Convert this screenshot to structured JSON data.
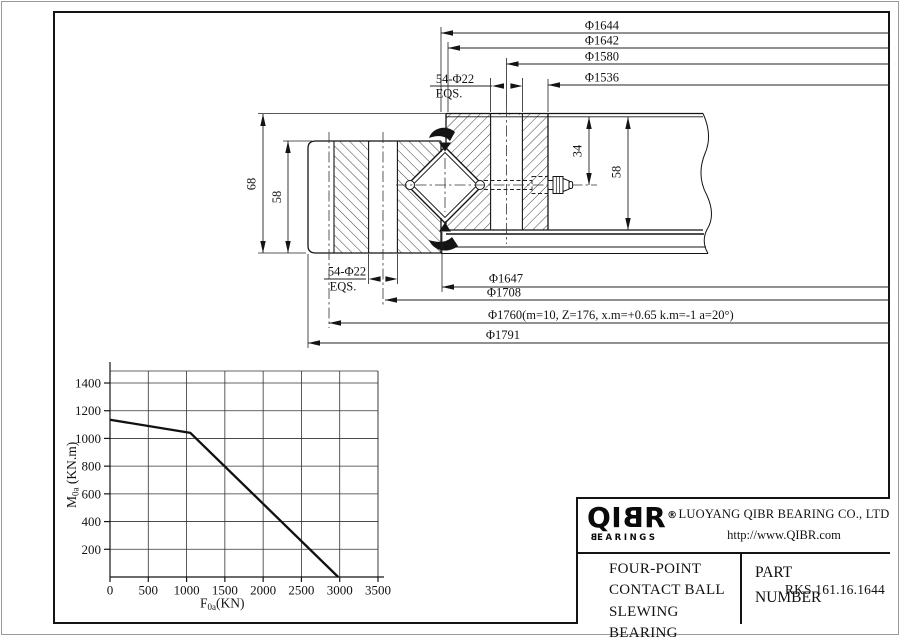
{
  "drawing": {
    "dims_top": [
      "Φ1644",
      "Φ1642",
      "Φ1580",
      "Φ1536"
    ],
    "bolt_top": {
      "line1": "54-Φ22",
      "line2": "EQS."
    },
    "bolt_bottom": {
      "line1": "54-Φ22",
      "line2": "EQS."
    },
    "dims_bottom": [
      "Φ1647",
      "Φ1708",
      "Φ1760(m=10, Z=176, x.m=+0.65 k.m=-1 a=20°)",
      "Φ1791"
    ],
    "dim_left_outer": "68",
    "dim_left_inner": "58",
    "dim_right_nipple": "34",
    "dim_right_height": "58"
  },
  "chart_data": {
    "type": "line",
    "title": "",
    "xlabel_parts": [
      "F",
      "0a",
      "(KN)"
    ],
    "ylabel_parts": [
      "M",
      "0a",
      " (KN.m)"
    ],
    "x_ticks": [
      0,
      500,
      1000,
      1500,
      2000,
      2500,
      3000,
      3500
    ],
    "y_ticks": [
      200,
      400,
      600,
      800,
      1000,
      1200,
      1400
    ],
    "xlim": [
      0,
      3500
    ],
    "ylim": [
      0,
      1480
    ],
    "grid": true,
    "legend": "none",
    "series": [
      {
        "name": "static-load-limit-curve",
        "points": [
          [
            0,
            1135
          ],
          [
            1050,
            1040
          ],
          [
            2980,
            0
          ]
        ]
      }
    ]
  },
  "title_block": {
    "logo_left": "QI",
    "logo_b": "B",
    "logo_right": "R",
    "registered": "®",
    "brand_b": "B",
    "brand_rest": "EARINGS",
    "company": "LUOYANG QIBR BEARING CO., LTD",
    "website": "http://www.QIBR.com",
    "product_line1": "FOUR-POINT",
    "product_line2": "CONTACT BALL",
    "product_line3": "SLEWING BEARING",
    "part_label_line1": "PART",
    "part_label_line2": "NUMBER",
    "part_number": "RKS.161.16.1644"
  }
}
